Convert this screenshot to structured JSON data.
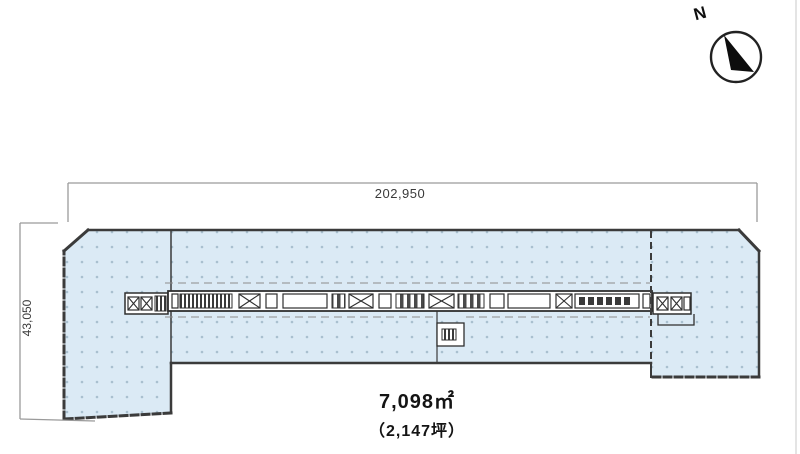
{
  "north": {
    "label": "N"
  },
  "dimensions": {
    "top_label": "202,950",
    "left_label": "43,050"
  },
  "area": {
    "line1": "7,098㎡",
    "line2": "（2,147坪）"
  },
  "colors": {
    "site_fill": "#dbeaf5",
    "dot": "#a9c0cf",
    "outline": "#3b3b3b",
    "building_line": "#2f2f2f",
    "canopy_line": "#8c8c8c",
    "dim_line": "#9a9a9a",
    "needle": "#0d0d0d"
  },
  "plan": {
    "site_polygon": [
      [
        88,
        230
      ],
      [
        739,
        230
      ],
      [
        759,
        251
      ],
      [
        759,
        377
      ],
      [
        651,
        377
      ],
      [
        651,
        363
      ],
      [
        171,
        363
      ],
      [
        171,
        413
      ],
      [
        64,
        419
      ],
      [
        64,
        251
      ]
    ],
    "edges": [
      {
        "x1": 88,
        "y1": 230,
        "x2": 739,
        "y2": 230,
        "dash": false,
        "w": 2.5
      },
      {
        "x1": 739,
        "y1": 230,
        "x2": 759,
        "y2": 251,
        "dash": false,
        "w": 3
      },
      {
        "x1": 759,
        "y1": 251,
        "x2": 759,
        "y2": 377,
        "dash": false,
        "w": 2.5
      },
      {
        "x1": 759,
        "y1": 377,
        "x2": 651,
        "y2": 377,
        "dash": true,
        "w": 3
      },
      {
        "x1": 651,
        "y1": 377,
        "x2": 651,
        "y2": 363,
        "dash": true,
        "w": 2
      },
      {
        "x1": 651,
        "y1": 363,
        "x2": 171,
        "y2": 363,
        "dash": false,
        "w": 2.5
      },
      {
        "x1": 171,
        "y1": 363,
        "x2": 171,
        "y2": 413,
        "dash": false,
        "w": 2.5
      },
      {
        "x1": 171,
        "y1": 413,
        "x2": 64,
        "y2": 419,
        "dash": true,
        "w": 3
      },
      {
        "x1": 64,
        "y1": 419,
        "x2": 64,
        "y2": 251,
        "dash": true,
        "w": 3
      },
      {
        "x1": 64,
        "y1": 251,
        "x2": 88,
        "y2": 230,
        "dash": false,
        "w": 3
      }
    ],
    "internal_lines": [
      {
        "x1": 171,
        "y1": 231,
        "x2": 171,
        "y2": 362,
        "dash": false,
        "w": 1.5
      },
      {
        "x1": 437,
        "y1": 311,
        "x2": 437,
        "y2": 362,
        "dash": false,
        "w": 1.2
      }
    ],
    "front_line": {
      "x1": 651,
      "y1": 231,
      "x2": 651,
      "y2": 376,
      "w": 2
    },
    "canopy_lines": [
      {
        "x1": 165,
        "y1": 283,
        "x2": 650,
        "y2": 283
      },
      {
        "x1": 165,
        "y1": 317,
        "x2": 434,
        "y2": 317
      },
      {
        "x1": 466,
        "y1": 317,
        "x2": 650,
        "y2": 317
      }
    ],
    "building": {
      "strip": {
        "x": 168,
        "y": 291,
        "w": 484,
        "h": 20
      },
      "tails": [
        {
          "x": 125,
          "y": 293,
          "w": 43,
          "h": 21
        },
        {
          "x": 653,
          "y": 293,
          "w": 38,
          "h": 21
        }
      ],
      "lip": [
        [
          658,
          314
        ],
        [
          658,
          325
        ],
        [
          694,
          325
        ],
        [
          694,
          314
        ]
      ],
      "protrusion": {
        "x": 437,
        "y": 323,
        "w": 27,
        "h": 23
      },
      "protrusion_core": {
        "x": 442,
        "y": 329,
        "w": 14,
        "h": 11
      },
      "segments": [
        {
          "x": 172,
          "w": 6,
          "t": "cell"
        },
        {
          "x": 180,
          "w": 52,
          "t": "hatch"
        },
        {
          "x": 239,
          "w": 21,
          "t": "x"
        },
        {
          "x": 266,
          "w": 11,
          "t": "cell"
        },
        {
          "x": 283,
          "w": 44,
          "t": "room"
        },
        {
          "x": 332,
          "w": 13,
          "t": "bars"
        },
        {
          "x": 349,
          "w": 24,
          "t": "x"
        },
        {
          "x": 379,
          "w": 12,
          "t": "cell"
        },
        {
          "x": 396,
          "w": 28,
          "t": "bars"
        },
        {
          "x": 429,
          "w": 25,
          "t": "x"
        },
        {
          "x": 458,
          "w": 26,
          "t": "bars"
        },
        {
          "x": 490,
          "w": 14,
          "t": "cell"
        },
        {
          "x": 508,
          "w": 42,
          "t": "room"
        },
        {
          "x": 556,
          "w": 16,
          "t": "x"
        },
        {
          "x": 575,
          "w": 64,
          "t": "squares"
        },
        {
          "x": 643,
          "w": 7,
          "t": "cell"
        }
      ],
      "seg_y": 294,
      "seg_h": 14,
      "tail_marks": [
        {
          "x": 128,
          "y": 297,
          "w": 11,
          "h": 13,
          "t": "x"
        },
        {
          "x": 141,
          "y": 297,
          "w": 11,
          "h": 13,
          "t": "x"
        },
        {
          "x": 155,
          "y": 296,
          "w": 11,
          "h": 15,
          "t": "hatch"
        },
        {
          "x": 657,
          "y": 297,
          "w": 11,
          "h": 13,
          "t": "x"
        },
        {
          "x": 671,
          "y": 297,
          "w": 11,
          "h": 13,
          "t": "x"
        },
        {
          "x": 684,
          "y": 297,
          "w": 6,
          "h": 13,
          "t": "cell"
        }
      ]
    },
    "dims": {
      "top": {
        "line": [
          68,
          183,
          757,
          183
        ],
        "ext": [
          [
            68,
            183,
            68,
            222
          ],
          [
            757,
            183,
            757,
            222
          ]
        ]
      },
      "left": {
        "line": [
          20,
          223,
          20,
          419
        ],
        "ext": [
          [
            20,
            223,
            58,
            223
          ],
          [
            20,
            419,
            95,
            421
          ]
        ]
      }
    },
    "compass": {
      "cx": 736,
      "cy": 57,
      "r": 25,
      "needle": [
        [
          724,
          35
        ],
        [
          754,
          72
        ],
        [
          731,
          70
        ]
      ]
    }
  }
}
